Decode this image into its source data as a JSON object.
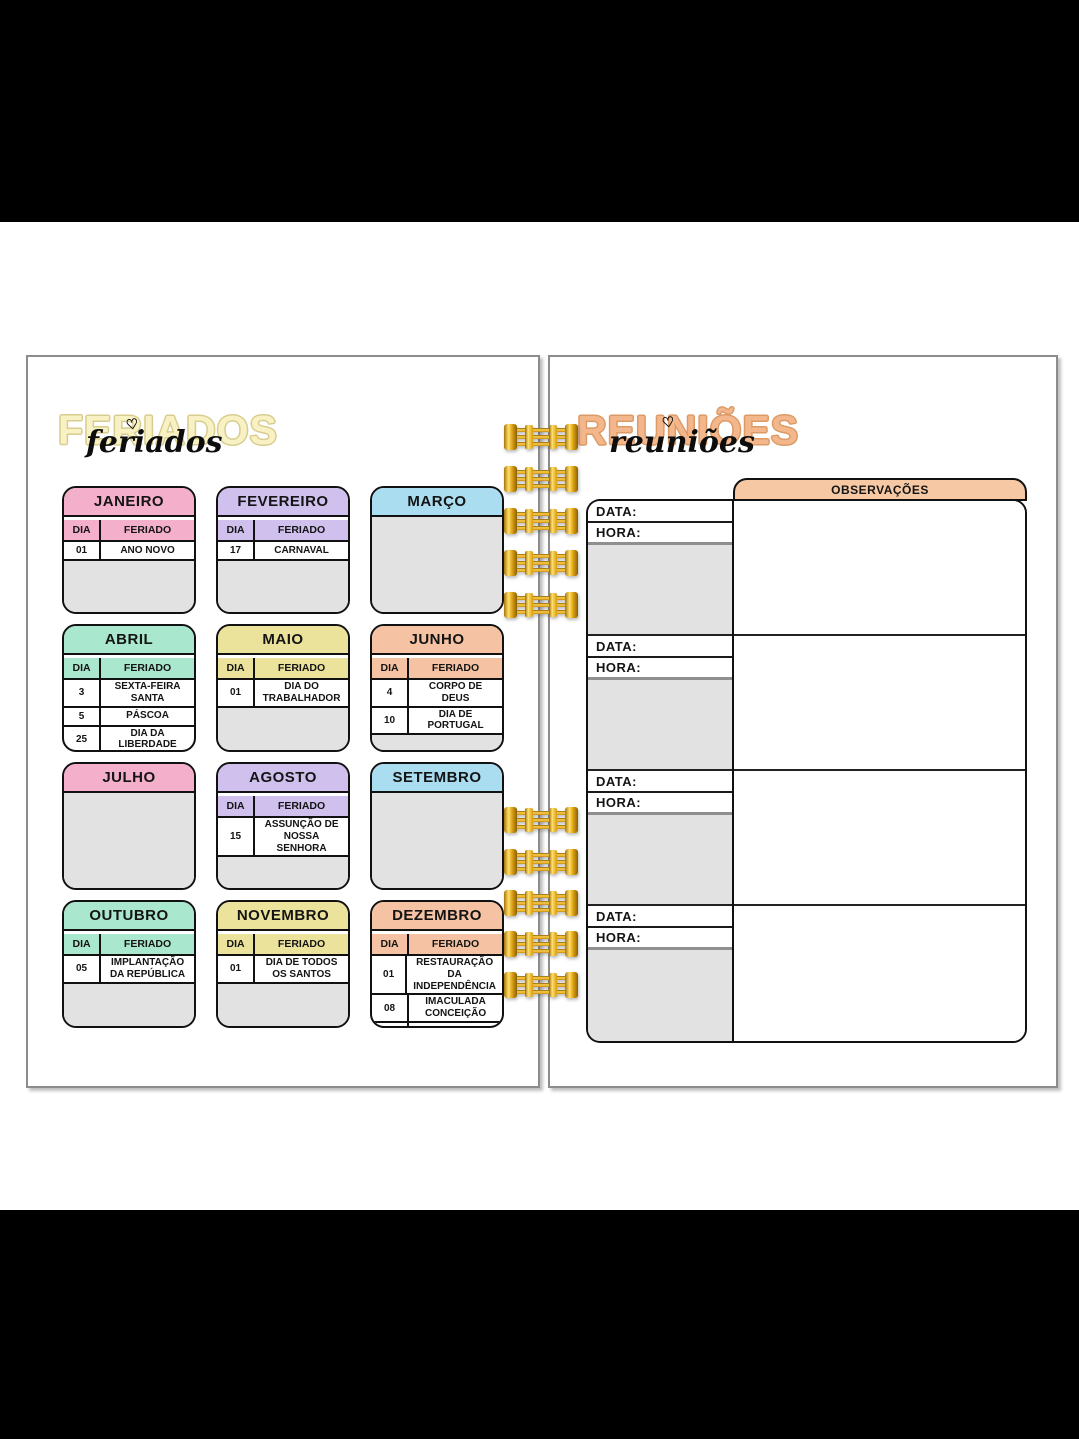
{
  "palette": {
    "pink": "#f4b0ca",
    "lavender": "#cfc0ee",
    "blue": "#abddf0",
    "mint": "#aae7cf",
    "yellow": "#ebe29b",
    "peach": "#f5c3a3",
    "panel_gray": "#e2e2e2",
    "ring_gold": "#f0b428",
    "page_border": "#8c8c8c",
    "left_title_fill": "#f8f1c3",
    "right_title_fill": "#f3b78b",
    "ink": "#111111"
  },
  "left_page": {
    "title_outline": "FERIADOS",
    "title_script": "feriados",
    "heart": "♡",
    "table_headers": {
      "day": "DIA",
      "holiday": "FERIADO"
    },
    "months": [
      {
        "name": "JANEIRO",
        "color": "pink",
        "rows": [
          {
            "day": "01",
            "holiday": "ANO NOVO"
          }
        ]
      },
      {
        "name": "FEVEREIRO",
        "color": "lavender",
        "rows": [
          {
            "day": "17",
            "holiday": "CARNAVAL"
          }
        ]
      },
      {
        "name": "MARÇO",
        "color": "blue",
        "rows": []
      },
      {
        "name": "ABRIL",
        "color": "mint",
        "rows": [
          {
            "day": "3",
            "holiday": "SEXTA-FEIRA SANTA"
          },
          {
            "day": "5",
            "holiday": "PÁSCOA"
          },
          {
            "day": "25",
            "holiday": "DIA DA LIBERDADE"
          }
        ]
      },
      {
        "name": "MAIO",
        "color": "yellow",
        "rows": [
          {
            "day": "01",
            "holiday": "DIA DO TRABALHADOR"
          }
        ]
      },
      {
        "name": "JUNHO",
        "color": "peach",
        "rows": [
          {
            "day": "4",
            "holiday": "CORPO DE DEUS"
          },
          {
            "day": "10",
            "holiday": "DIA DE PORTUGAL"
          }
        ]
      },
      {
        "name": "JULHO",
        "color": "pink",
        "rows": []
      },
      {
        "name": "AGOSTO",
        "color": "lavender",
        "rows": [
          {
            "day": "15",
            "holiday": "ASSUNÇÃO DE NOSSA SENHORA"
          }
        ]
      },
      {
        "name": "SETEMBRO",
        "color": "blue",
        "rows": []
      },
      {
        "name": "OUTUBRO",
        "color": "mint",
        "rows": [
          {
            "day": "05",
            "holiday": "IMPLANTAÇÃO DA REPÚBLICA"
          }
        ]
      },
      {
        "name": "NOVEMBRO",
        "color": "yellow",
        "rows": [
          {
            "day": "01",
            "holiday": "DIA DE TODOS OS SANTOS"
          }
        ]
      },
      {
        "name": "DEZEMBRO",
        "color": "peach",
        "rows": [
          {
            "day": "01",
            "holiday": "RESTAURAÇÃO DA INDEPENDÊNCIA"
          },
          {
            "day": "08",
            "holiday": "IMACULADA CONCEIÇÃO"
          },
          {
            "day": "25",
            "holiday": "NATAL"
          }
        ]
      }
    ]
  },
  "right_page": {
    "title_outline": "REUNIÕES",
    "title_script": "reuniões",
    "heart": "♡",
    "observations_header": "OBSERVAÇÕES",
    "labels": {
      "date": "DATA:",
      "time": "HORA:"
    },
    "sections_count": 4
  }
}
